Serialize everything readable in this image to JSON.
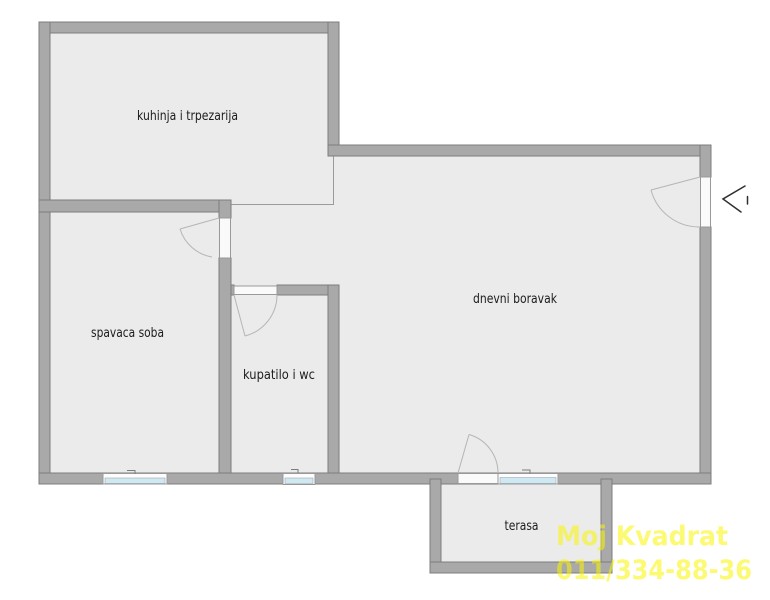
{
  "colors": {
    "background": "#ffffff",
    "floor": "#ebebeb",
    "wall_fill": "#a9a9a9",
    "wall_stroke": "#7d7d7d",
    "boundary_line": "#9a9a9a",
    "window_glass": "#cfe9f4",
    "window_frame": "#fdfdfd",
    "door_fill": "#fafafa",
    "door_stroke": "#999999",
    "door_arc": "#b5b5b5",
    "entrance_arrow": "#2f2f2f",
    "label_text": "#1c1c1c",
    "watermark_text": "#faf500"
  },
  "rooms": {
    "kitchen": {
      "label": "kuhinja i trpezarija"
    },
    "bedroom": {
      "label": "spavaca soba"
    },
    "bathroom": {
      "label": "kupatilo i wc"
    },
    "living": {
      "label": "dnevni boravak"
    },
    "terrace": {
      "label": "terasa"
    }
  },
  "icons": {
    "entrance_arrow": "chevron-left-with-tick"
  },
  "watermark": {
    "line1": "Moj Kvadrat",
    "line2": "011/334-88-36"
  }
}
